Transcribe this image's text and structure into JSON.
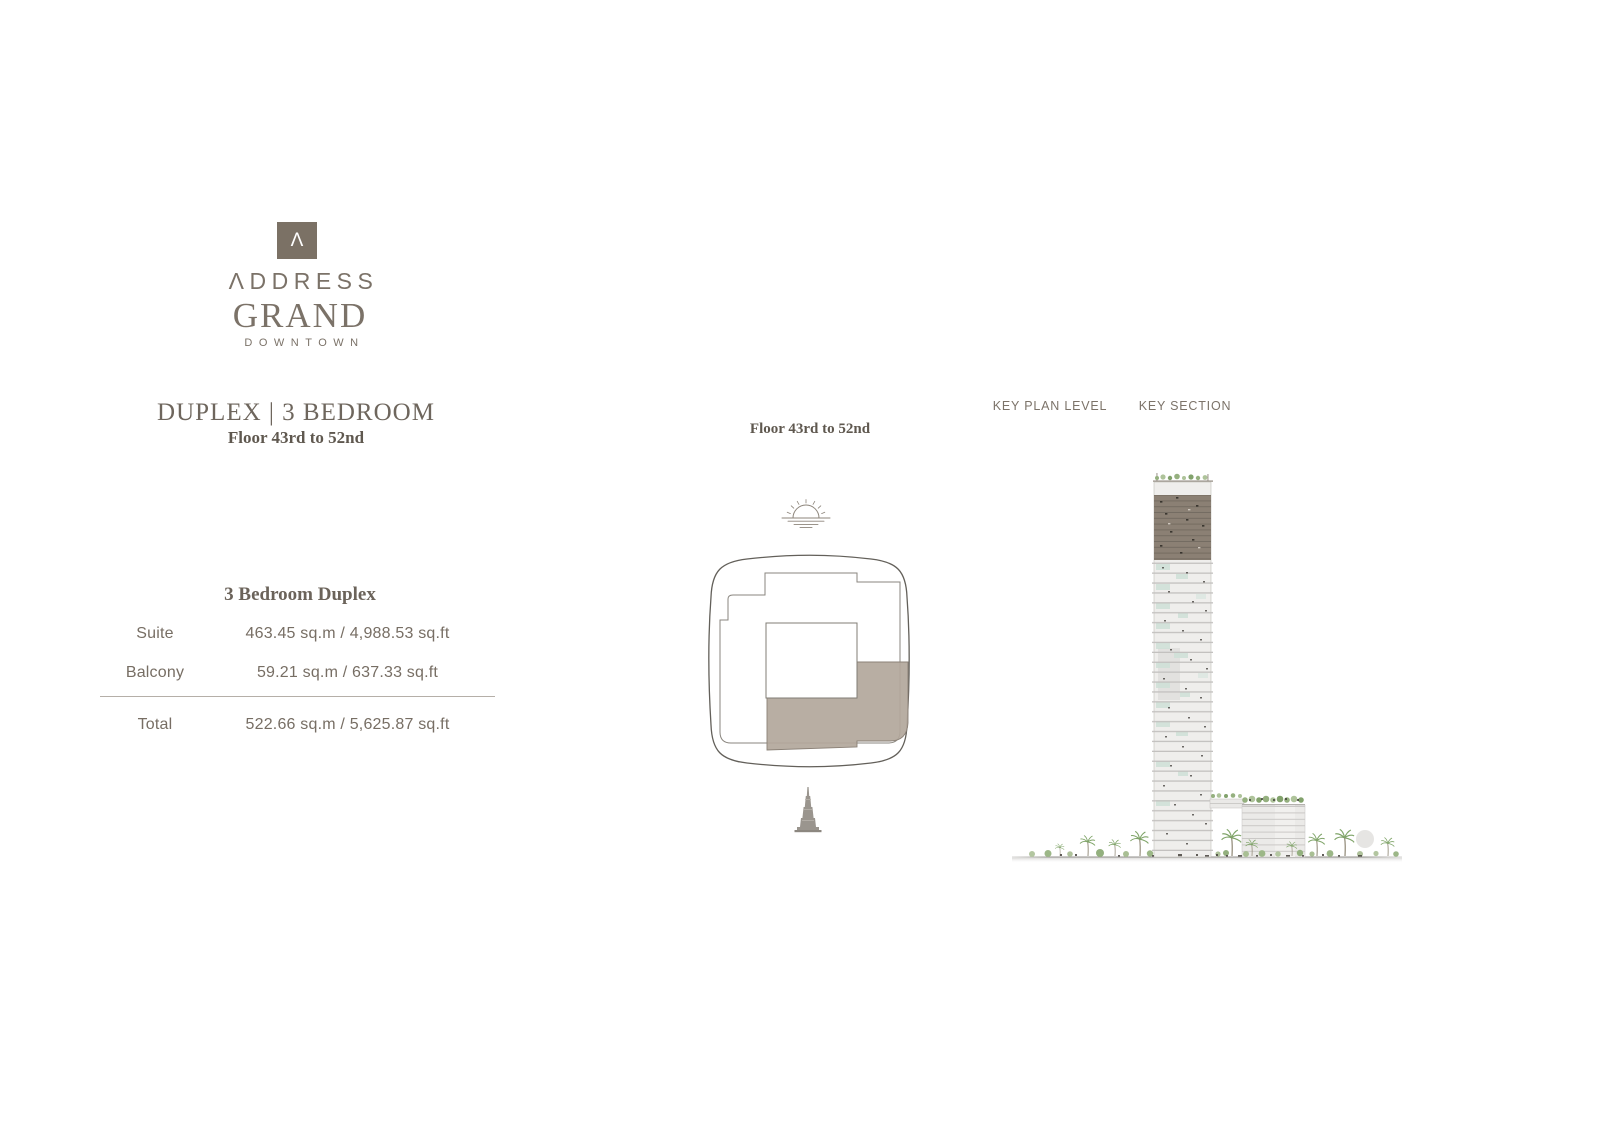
{
  "brand": {
    "mark": "Λ",
    "line1": "ΛDDRESS",
    "line2": "GRAND",
    "line3": "DOWNTOWN",
    "color": "#7b7165"
  },
  "unit": {
    "title": "DUPLEX | 3 BEDROOM",
    "floor_range": "Floor 43rd to 52nd"
  },
  "area_table": {
    "heading": "3 Bedroom Duplex",
    "rows": [
      {
        "label": "Suite",
        "value": "463.45 sq.m / 4,988.53 sq.ft"
      },
      {
        "label": "Balcony",
        "value": "59.21 sq.m / 637.33 sq.ft"
      },
      {
        "label": "Total",
        "value": "522.66 sq.m / 5,625.87 sq.ft"
      }
    ]
  },
  "key_plan": {
    "floor_label": "Floor 43rd to 52nd",
    "highlight_color": "#b2a79b",
    "icons": {
      "orientation": "sunrise-over-water-icon",
      "landmark": "burj-khalifa-icon"
    }
  },
  "key_section": {
    "label_plan_level": "KEY PLAN LEVEL",
    "label_section": "KEY SECTION",
    "highlight_color": "#8b8074"
  }
}
